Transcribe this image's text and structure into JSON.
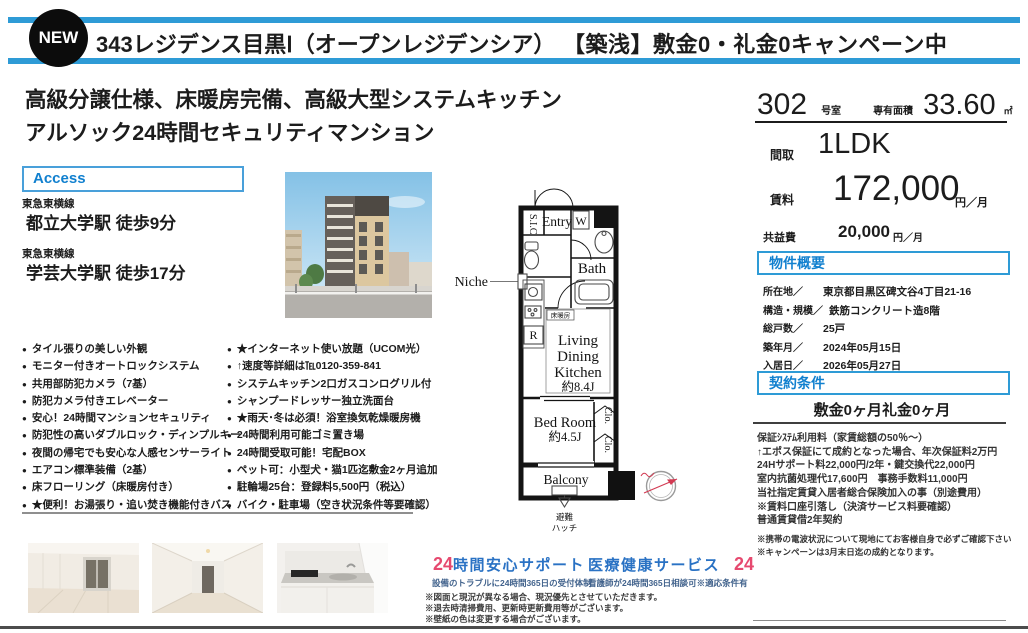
{
  "colors": {
    "accent_blue": "#2e9bd6",
    "section_title_blue": "#1180cf",
    "service_blue": "#2a72c4",
    "service_pink": "#e6496f"
  },
  "icons": {
    "bullet": "●"
  },
  "header": {
    "badge": "NEW",
    "title": "343レジデンス目黒Ⅰ（オープンレジデンシア）",
    "campaign": "【築浅】敷金0・礼金0キャンペーン中"
  },
  "headline": {
    "line1": "高級分譲仕様、床暖房完備、高級大型システムキッチン",
    "line2": "アルソック24時間セキュリティマンション"
  },
  "access": {
    "label": "Access",
    "routes": [
      {
        "line": "東急東横線",
        "station": "都立大学駅 徒歩9分"
      },
      {
        "line": "東急東横線",
        "station": "学芸大学駅 徒歩17分"
      }
    ]
  },
  "unit": {
    "room_number": "302",
    "room_number_label": "号室",
    "area_label": "専有面積",
    "area": "33.60",
    "area_unit": "㎡",
    "layout_label": "間取",
    "layout": "1LDK",
    "rent_label": "賃料",
    "rent": "172,000",
    "rent_unit": "円／月",
    "fee_label": "共益費",
    "fee": "20,000",
    "fee_unit": "円／月"
  },
  "overview": {
    "title": "物件概要",
    "rows": [
      {
        "label": "所在地／",
        "value": "東京都目黒区碑文谷4丁目21-16"
      },
      {
        "label": "構造・規模／",
        "value": "鉄筋コンクリート造8階"
      },
      {
        "label": "総戸数／",
        "value": "25戸"
      },
      {
        "label": "築年月／",
        "value": "2024年05月15日"
      },
      {
        "label": "入居日／",
        "value": "2026年05月27日"
      }
    ]
  },
  "contract": {
    "title": "契約条件",
    "deposit": "敷金0ヶ月礼金0ヶ月",
    "notes": [
      "保証ｼｽﾃﾑ利用料（家賃総額の50％～）",
      "↑エポス保証にて成約となった場合、年次保証料2万円",
      "24Hサポート料22,000円/2年・鍵交換代22,000円",
      "室内抗菌処理代17,600円　事務手数料11,000円",
      "当社指定賃貸入居者総合保険加入の事（別途費用）",
      "※賃料口座引落し（決済サービス料要確認）",
      "普通賃貸借2年契約"
    ],
    "notes2": [
      "※携帯の電波状況について現地にてお客様自身で必ずご確認下さい",
      "※キャンペーンは3月末日迄の成約となります。"
    ]
  },
  "features_left": [
    "タイル張りの美しい外観",
    "モニター付きオートロックシステム",
    "共用部防犯カメラ（7基）",
    "防犯カメラ付きエレベーター",
    "安心！24時間マンションセキュリティ",
    "防犯性の高いダブルロック・ディンプルキー",
    "夜間の帰宅でも安心な人感センサーライト",
    "エアコン標準装備（2基）",
    "床フローリング（床暖房付き）",
    "★便利！お湯張り・追い焚き機能付きバス"
  ],
  "features_right": [
    "★インターネット使い放題（UCOM光）",
    "↑速度等詳細は℡0120-359-841",
    "システムキッチン2口ガスコンログリル付",
    "シャンプードレッサー独立洗面台",
    "★雨天･冬は必須！浴室換気乾燥暖房機",
    "24時間利用可能ゴミ置き場",
    "24時間受取可能！宅配BOX",
    "ペット可：小型犬・猫1匹迄敷金2ヶ月追加",
    "駐輪場25台：登録料5,500円（税込）",
    "バイク・駐車場（空き状況条件等要確認）"
  ],
  "floorplan": {
    "sic": "S.I.C",
    "entry": "Entry",
    "w": "W",
    "bath": "Bath",
    "niche": "Niche",
    "floor_heating": "床暖房",
    "ldk_l1": "Living",
    "ldk_l2": "Dining",
    "ldk_l3": "Kitchen",
    "ldk_size": "約8.4J",
    "r": "R",
    "bedroom": "Bed Room",
    "bedroom_size": "約4.5J",
    "clo": "Clo.",
    "balcony": "Balcony",
    "hatch_l1": "避難",
    "hatch_l2": "ハッチ"
  },
  "services": {
    "support": {
      "num": "24",
      "title": "時間安心サポート",
      "subtitle": "設備のトラブルに24時間365日の受付体制"
    },
    "medical": {
      "title": "医療健康サービス",
      "num": "24",
      "subtitle": "看護師が24時間365日相談可※適応条件有"
    }
  },
  "footnotes": [
    "※図面と現況が異なる場合、現況優先とさせていただきます。",
    "※退去時清掃費用、更新時更新費用等がございます。",
    "※壁紙の色は変更する場合がございます。"
  ]
}
